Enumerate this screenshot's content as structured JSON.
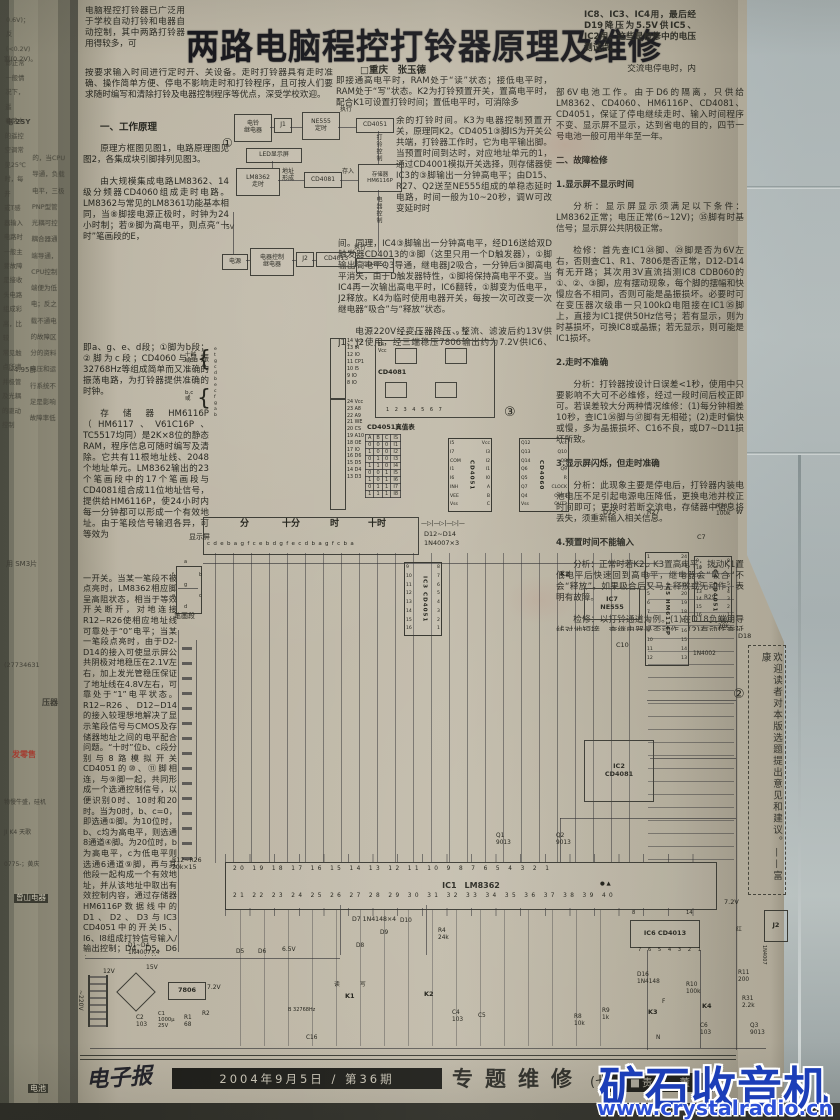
{
  "article": {
    "title": "两路电脑程控打铃器原理及维修",
    "byline": "□重庆　张玉德",
    "pre_title": "电脑程控打铃器已广泛用于学校自动打铃和电器自动控制，其中两路打铃器用得较多，可",
    "intro": "按要求输入时间进行定时开、关设备。走时打铃器具有走时准确、操作简单方便、停电不影响走时和打铃程序，且可按人们要求随时编写和清除打铃及电器控制程序等优点，深受学校欢迎。",
    "sec1_heading": "一、工作原理",
    "left_p1": "原理方框图见图1，电路原理图见图2，各集成块引脚排列见图3。",
    "left_p2": "由大规模集成电路LM8362、14级分频器CD4060组成走时电路。LM8362与常见的LM8361功能基本相同，当⑧脚接电源正极时，时钟为24小时制；若⑨脚为高电平，则点亮“十时”笔画段的E，",
    "left_p3": "即a、g、e、d段；①脚为b段；②脚为c段；CD4060与晶振32768Hz等组成简单而又准确的振荡电路，为打铃器提供准确的时钟。",
    "left_p4": "存储器HM6116P（HM6117、V61C16P、TC5517均同）是2K×8位的静态RAM，程序信息可随时编写及清除。它共有11根地址线、2048个地址单元。LM8362输出的23个笔画段中的17个笔画段与CD4081组合成11位地址信号，提供给HM6116P，使24小时内每一分钟都可以形成一个有效地址。由于笔段信号输迥各异，可等效为",
    "left_p5": "一开关。当某一笔段不被点亮时，LM8362相应脚呈高阻状态，相当于等效开关断开，对地连接R12~R26使相应地址线可靠处于“0”电平；当某一笔段点亮时，由于D2-D14的接入可使显示屏公共阴极对地稳压在2.1V左右，加上发光管稳压保证了地址线在4.8V左右，可靠处于“1”电平状态。R12~R26、D12~D14的接入较理想地解决了显示笔段信号与CMOS及存储器地址之间的电平配合问题。“十时”位b、c段分别与8路模拟开关CD4051的⑩、⑪脚相连，与⑨脚一起，共同形成一个选通控制信号，以便识别0时、10时和20时。当为0时，b、c=0，即选通①脚。为10位时，b、c均为高电平，则选通8通道④脚。为20位时，b为高电平，c为低电平则选通6通道⑨脚，再与其他段一起构成一个有效地址，并从该地址中取出有效控制内容，通过存储器HM6116P数据线中的D1、D2、D3与IC3 CD4051中的开关I5、I6、I8组成打铃信号输入/输出控制；D4、D5、D6与IC4 CD4051中的I5-I8组成电器控制输入/输出信号控制。",
    "left_p6": "K1是选择读/写程序控制键，内接HM6116P的㉑脚WE端，它是编程写入端，",
    "mid_w1": "即接通高电平时，RAM处于“读”状态；接低电平时，RAM处于“写”状态。K2为打铃预置开关，置高电平时，配合K1可设置打铃时间；置低电平时，可消除多",
    "mid_n1": "余的打铃时间。K3为电器控制预置开关，原理同K2。CD4051③脚IS为开关公共端，打铃器工作时，它为电平输出脚。当预置时间到达时，对应地址单元的1，通过CD4001模拟开关选择，则存储器使IC3的③脚输出一分钟高电平；由D15、R27、Q2送至NE555组成的单稳态延时电路，时间一般为10~20秒，调W可改变延时时",
    "mid_w2": "间。同理，IC4③脚输出一分钟高电平，经D16送给双D触发器CD4013的③脚（这里只用一个D触发器），①脚输出高电平Q3导通，继电器J2吸合，一分钟后③脚高电平消失，由于D触发器特性，①脚将保持高电平不变。当IC4再一次输出高电平时，IC6翻转，①脚变为低电平，J2释放。K4为临时使用电器开关，每按一次可改变一次继电器“吸合”与“释放”状态。",
    "mid_w3": "电源220V经变压器降压、整流、滤波后约13V供J1、J2使用，经三端稳压7806输出约为7.2V供IC6、IC7及电器使用；再经D5、D6降压后为6.5V供IC1、",
    "right_top": "IC8、IC3、IC4用，最后经D19降压为5.5V供IC5、IC2用。这些是检修中的电压测试点。",
    "right_top2": "交流电停电时，内",
    "r1": "部6V电池工作。由于D6的隔离，只供给LM8362、CD4060、HM6116P、CD4081、CD4051，保证了停电继续走时、输入时间程序不变、显示屏不显示，达到省电的目的，四节一号电池一般可用半年至一年。",
    "h2": "二、故障检修",
    "h3": "1.显示屏不显示时间",
    "r2": "分析：显示屏显示须满足以下条件：LM8362正常；电压正常(6~12V)；㉟脚有时基信号；显示屏公共阴极正常。",
    "r3": "检修：首先查IC1㉘脚、㉙脚是否为6V左右，否则查C1、R1、7806是否正常，D12-D14有无开路；其次用3V直流挡测IC8 CDB060的①、②、③脚，应有摆动现象，每个脚的摆幅和快慢应各不相同，否则可能是晶振损坏。必要时可在变压器次级串一只100kΩ电阻接在IC1㉟脚上，直接为IC1提供50Hz信号；若有显示，则为时基损坏，可换IC8或晶振；若无显示，则可能是IC1损坏。",
    "h4": "2.走时不准确",
    "r4": "分析：打铃器按设计日误差<1秒，使用中只要影响不大可不必维修，经过一段时间后校正即可。若误差较大分两种情况维修：(1)每分钟相差10秒，查IC1㊱脚与㊲脚有无相碰；(2)走时偏快或慢，多为晶振损坏、C16不良，或D7~D11损坏所致。",
    "h5": "3.显示屏闪烁，但走时准确",
    "r5": "分析：此现象主要是停电后，打铃器内装电池电压不足引起电源电压降低，更换电池并校正时间即可；更换时若断交流电，存储器中信息将丢失，须重新输入相关信息。",
    "h6": "4.预置时间不能输入",
    "r6": "分析：正常时若K2、K3置高电平；拨动K1置低电平后快速回到高电平，继电器会“吸合”不会“释放”。如果吸合后又马上释放或无动作，表明有故障。",
    "r7": "检修：以打铃通道为例。(1)在D18负端用导线对地短接，查继电器是否动作。(2)有动作查延时部分，将D15正极与电源正极短接，看继电器是否动作，否则查NE555及外围元件和Q2是否损坏。(3)查K1是否接触良好，IC5㉑脚电压是否为5.5V左右。(4)查D12-D14是否损坏。(5)若无任何显示可对照真值表试之。(6)以上检查正常仍不能输入，可能是存储器损坏，可直接换IC5或用第4节方法检查。",
    "continue_note": "(下转本期第六版)"
  },
  "figure1": {
    "marker": "①",
    "bell": "电铃\n继电器",
    "j1": "J1",
    "ne555": "NE555\n定时",
    "cd4051a": "CD4051",
    "exec1": "执行",
    "led": "LED显示屏",
    "lm8362": "LM8362\n走时",
    "addr": "地址\n形成",
    "cd4081": "CD4081",
    "store": "存入",
    "mem": "存储器\nHM6116P",
    "bell_ctrl": "打铃控制",
    "dev_ctrl": "电器控制",
    "v5": "5V",
    "power": "电源",
    "ctrl_relay": "电器控制\n继电器",
    "j2": "J2",
    "cd4013": "CD4013",
    "exec2": "执行",
    "cd4051b": "CD4051"
  },
  "figure3": {
    "truth": {
      "title": "CD4051真值表",
      "head": [
        "A",
        "B",
        "C",
        "IS"
      ],
      "rows": [
        [
          "0",
          "0",
          "0",
          "I1"
        ],
        [
          "1",
          "0",
          "0",
          "I2"
        ],
        [
          "0",
          "1",
          "0",
          "I3"
        ],
        [
          "1",
          "1",
          "0",
          "I4"
        ],
        [
          "0",
          "0",
          "1",
          "I5"
        ],
        [
          "1",
          "0",
          "1",
          "I6"
        ],
        [
          "0",
          "1",
          "1",
          "I7"
        ],
        [
          "1",
          "1",
          "1",
          "I8"
        ]
      ]
    },
    "dips": [
      {
        "name": "CD4051",
        "left": [
          "I5",
          "I7",
          "COM",
          "I1",
          "I6",
          "INH",
          "VEE",
          "Vss"
        ],
        "right": [
          "Vcc",
          "I3",
          "I2",
          "I1",
          "I0",
          "A",
          "B",
          "C"
        ],
        "x": 448,
        "y": 438,
        "w": 42,
        "h": 72
      },
      {
        "name": "CD4060",
        "left": [
          "Q12",
          "Q13",
          "Q14",
          "Q6",
          "Q5",
          "Q7",
          "Q4",
          "Vss"
        ],
        "right": [
          "Vcc",
          "Q10",
          "Q8",
          "Q9",
          "R",
          "CLOCK",
          "OUT1",
          "OUT2"
        ],
        "x": 519,
        "y": 438,
        "w": 48,
        "h": 72
      },
      {
        "name": "IC3 CD4051",
        "left": [
          "9",
          "10",
          "11",
          "12",
          "13",
          "14",
          "15",
          "16"
        ],
        "right": [
          "8",
          "7",
          "6",
          "5",
          "4",
          "3",
          "2",
          "1"
        ],
        "x": 404,
        "y": 562,
        "w": 36,
        "h": 72
      },
      {
        "name": "IC4 CD4051",
        "left": [
          "9",
          "10",
          "11",
          "12",
          "13",
          "14",
          "15",
          "16"
        ],
        "right": [
          "8",
          "7",
          "6",
          "5",
          "4",
          "3",
          "2",
          "1"
        ],
        "x": 694,
        "y": 556,
        "w": 36,
        "h": 64
      },
      {
        "name": "IC5 HM6116P",
        "left": [
          "1",
          "2",
          "3",
          "4",
          "5",
          "6",
          "7",
          "8",
          "9",
          "10",
          "11",
          "12"
        ],
        "right": [
          "24",
          "23",
          "22",
          "21",
          "20",
          "19",
          "18",
          "17",
          "16",
          "15",
          "14",
          "13"
        ],
        "x": 645,
        "y": 552,
        "w": 42,
        "h": 112
      }
    ]
  },
  "schematic": {
    "ic7_label": "IC7\nNE555",
    "ic2_label": "IC2\nCD4081",
    "ic6_label": "IC6  CD4013",
    "ic1_label": "IC1　LM8362",
    "j2_label": "J2",
    "reg_label": "7806",
    "labels": [
      {
        "t": "显示屏",
        "x": 189,
        "y": 533,
        "s": 7
      },
      {
        "t": "分",
        "x": 240,
        "y": 519,
        "s": 9,
        "b": 1
      },
      {
        "t": "十分",
        "x": 282,
        "y": 519,
        "s": 9,
        "b": 1
      },
      {
        "t": "时",
        "x": 330,
        "y": 519,
        "s": 9,
        "b": 1
      },
      {
        "t": "十时",
        "x": 368,
        "y": 519,
        "s": 9,
        "b": 1
      },
      {
        "t": "c d e b a g f c e b d g f e c d b a g f c b a",
        "x": 207,
        "y": 541,
        "s": 5.5,
        "ls": 0.8
      },
      {
        "t": "—▷|—▷|—▷|—",
        "x": 421,
        "y": 521,
        "s": 6
      },
      {
        "t": "D12~D14",
        "x": 424,
        "y": 531,
        "s": 6.5
      },
      {
        "t": "1N4007×3",
        "x": 424,
        "y": 540,
        "s": 6.5
      },
      {
        "t": "笔画段",
        "x": 174,
        "y": 612,
        "s": 7
      },
      {
        "t": "a",
        "x": 184,
        "y": 560,
        "s": 5
      },
      {
        "t": "f",
        "x": 172,
        "y": 573,
        "s": 5
      },
      {
        "t": "b",
        "x": 199,
        "y": 573,
        "s": 5
      },
      {
        "t": "g",
        "x": 184,
        "y": 583,
        "s": 5
      },
      {
        "t": "e",
        "x": 172,
        "y": 594,
        "s": 5
      },
      {
        "t": "c",
        "x": 199,
        "y": 594,
        "s": 5
      },
      {
        "t": "d",
        "x": 184,
        "y": 605,
        "s": 5
      },
      {
        "t": "十时\n或",
        "x": 185,
        "y": 352,
        "s": 5.5
      },
      {
        "t": "b,c\n或",
        "x": 185,
        "y": 390,
        "s": 5.5
      },
      {
        "t": "{",
        "x": 197,
        "y": 347,
        "s": 22
      },
      {
        "t": "{",
        "x": 197,
        "y": 386,
        "s": 22
      },
      {
        "t": "e\nt\ng\nc\nd\nb\ne\nc\nf\ng\na\nb",
        "x": 214,
        "y": 347,
        "s": 4.6,
        "lh": 1.3
      },
      {
        "t": "14 Vcc\n13 IR\n12 IO\n11 CP1\n10 I5\n 9 IO\n 8 IO",
        "x": 347,
        "y": 339,
        "s": 4.8,
        "lh": 1.45
      },
      {
        "t": "24 Vcc\n23 A8\n22 A9\n21 WE\n20 CS\n19 A10\n18 OE\n17 IO\n16 D6\n15 D5\n14 D4\n13 D3",
        "x": 347,
        "y": 400,
        "s": 4.8,
        "lh": 1.42
      },
      {
        "t": "CD4081",
        "x": 378,
        "y": 369,
        "s": 6.5,
        "b": 1
      },
      {
        "t": "14\nVcc",
        "x": 378,
        "y": 343,
        "s": 4.8
      },
      {
        "t": "13    12    11    10     9     8",
        "x": 400,
        "y": 332,
        "s": 5,
        "ls": 2
      },
      {
        "t": "1     2     3     4     5     6     7",
        "x": 386,
        "y": 408,
        "s": 5,
        "ls": 2
      },
      {
        "t": "CD4051真值表",
        "x": 367,
        "y": 424,
        "s": 6.5,
        "b": 1
      },
      {
        "t": "③",
        "x": 504,
        "y": 406,
        "s": 13
      },
      {
        "t": "②",
        "x": 733,
        "y": 688,
        "s": 13
      },
      {
        "t": "D15",
        "x": 603,
        "y": 509,
        "s": 6.5
      },
      {
        "t": "R27",
        "x": 647,
        "y": 509,
        "s": 6.5
      },
      {
        "t": "R28\n100k",
        "x": 716,
        "y": 504,
        "s": 5.8
      },
      {
        "t": "W",
        "x": 736,
        "y": 509,
        "s": 6.5
      },
      {
        "t": "C7",
        "x": 697,
        "y": 534,
        "s": 6.5
      },
      {
        "t": "K2",
        "x": 560,
        "y": 571,
        "s": 6.5,
        "b": 1
      },
      {
        "t": "C10",
        "x": 616,
        "y": 642,
        "s": 6.5
      },
      {
        "t": "R29",
        "x": 704,
        "y": 595,
        "s": 5.8
      },
      {
        "t": "R20\n20k",
        "x": 718,
        "y": 617,
        "s": 5.8
      },
      {
        "t": "D18",
        "x": 738,
        "y": 633,
        "s": 6.5
      },
      {
        "t": "1N4002",
        "x": 693,
        "y": 651,
        "s": 5.8
      },
      {
        "t": "Q1\n9013",
        "x": 496,
        "y": 833,
        "s": 5.8
      },
      {
        "t": "Q2\n9013",
        "x": 556,
        "y": 833,
        "s": 5.8
      },
      {
        "t": "R12~R26\n20k×15",
        "x": 172,
        "y": 857,
        "s": 6.2
      },
      {
        "t": "20 19 18 17 16 15 14 13 12 11 10  9  8  7  6  5  4  3  2  1",
        "x": 233,
        "y": 866,
        "s": 5.8,
        "ls": 3.4
      },
      {
        "t": "21 22 23 24 25 26 27 28 29 30 31 32 33 34 35 36 37 38 39 40",
        "x": 233,
        "y": 893,
        "s": 5.8,
        "ls": 3.4
      },
      {
        "t": "● ▲",
        "x": 600,
        "y": 881,
        "s": 5.5
      },
      {
        "t": "D7  1N4148×4",
        "x": 352,
        "y": 916,
        "s": 6.2
      },
      {
        "t": "D8",
        "x": 356,
        "y": 943,
        "s": 5.8
      },
      {
        "t": "D9",
        "x": 380,
        "y": 930,
        "s": 5.8
      },
      {
        "t": "D10",
        "x": 400,
        "y": 918,
        "s": 5.8
      },
      {
        "t": "R4\n24k",
        "x": 438,
        "y": 928,
        "s": 5.8
      },
      {
        "t": "8",
        "x": 632,
        "y": 911,
        "s": 5.2
      },
      {
        "t": "14",
        "x": 686,
        "y": 911,
        "s": 5.2
      },
      {
        "t": "7 6 5 4 3 2 1",
        "x": 638,
        "y": 948,
        "s": 5.2,
        "ls": 2.5
      },
      {
        "t": "D16\n1N4148",
        "x": 637,
        "y": 972,
        "s": 5.8
      },
      {
        "t": "R10\n100k",
        "x": 686,
        "y": 982,
        "s": 5.8
      },
      {
        "t": "K4",
        "x": 702,
        "y": 1003,
        "s": 6.5,
        "b": 1
      },
      {
        "t": "C6\n103",
        "x": 700,
        "y": 1023,
        "s": 5.8
      },
      {
        "t": "K3",
        "x": 648,
        "y": 1009,
        "s": 6.5,
        "b": 1
      },
      {
        "t": "F",
        "x": 662,
        "y": 999,
        "s": 5.8
      },
      {
        "t": "N",
        "x": 656,
        "y": 1035,
        "s": 5.8
      },
      {
        "t": "R9\n1k",
        "x": 602,
        "y": 1008,
        "s": 5.8
      },
      {
        "t": "R8\n10k",
        "x": 574,
        "y": 1014,
        "s": 5.8
      },
      {
        "t": "R11\n200",
        "x": 738,
        "y": 970,
        "s": 5.8
      },
      {
        "t": "R31\n2.2k",
        "x": 742,
        "y": 996,
        "s": 5.8
      },
      {
        "t": "Q3\n9013",
        "x": 750,
        "y": 1023,
        "s": 5.8
      },
      {
        "t": "1N4007",
        "x": 760,
        "y": 945,
        "s": 5,
        "v": 1
      },
      {
        "t": "红",
        "x": 736,
        "y": 927,
        "s": 5.8
      },
      {
        "t": "7.2V",
        "x": 724,
        "y": 899,
        "s": 6.5
      },
      {
        "t": "~220V",
        "x": 76,
        "y": 990,
        "s": 6,
        "v": 1
      },
      {
        "t": "12V",
        "x": 103,
        "y": 969,
        "s": 6
      },
      {
        "t": "D1~D4\n1N4007×4",
        "x": 128,
        "y": 943,
        "s": 5.8
      },
      {
        "t": "15V",
        "x": 146,
        "y": 965,
        "s": 6
      },
      {
        "t": "7.2V",
        "x": 207,
        "y": 985,
        "s": 6
      },
      {
        "t": "C2\n103",
        "x": 136,
        "y": 1015,
        "s": 5.8
      },
      {
        "t": "C1\n1000µ\n25V",
        "x": 158,
        "y": 1012,
        "s": 5.2
      },
      {
        "t": "R1\n68",
        "x": 184,
        "y": 1015,
        "s": 5.8
      },
      {
        "t": "R2",
        "x": 202,
        "y": 1011,
        "s": 5.8
      },
      {
        "t": "D5",
        "x": 236,
        "y": 949,
        "s": 5.8
      },
      {
        "t": "D6",
        "x": 258,
        "y": 949,
        "s": 5.8
      },
      {
        "t": "6.5V",
        "x": 282,
        "y": 947,
        "s": 6
      },
      {
        "t": "读",
        "x": 334,
        "y": 982,
        "s": 5.8
      },
      {
        "t": "K1",
        "x": 345,
        "y": 993,
        "s": 6.5,
        "b": 1
      },
      {
        "t": "写",
        "x": 360,
        "y": 982,
        "s": 5.8
      },
      {
        "t": "B 32768Hz",
        "x": 288,
        "y": 1008,
        "s": 5
      },
      {
        "t": "C16",
        "x": 306,
        "y": 1035,
        "s": 5.8
      },
      {
        "t": "K2",
        "x": 424,
        "y": 991,
        "s": 6.5,
        "b": 1
      },
      {
        "t": "C4\n103",
        "x": 452,
        "y": 1010,
        "s": 5.8
      },
      {
        "t": "C5",
        "x": 478,
        "y": 1013,
        "s": 5.8
      }
    ]
  },
  "notice": {
    "text": "欢迎读者对本版选题提出意见和建议。——富康"
  },
  "footer": {
    "logo": "电子报",
    "date_issue": "2004年9月5日 / 第36期",
    "section": "专题维修",
    "edition": "(七版)",
    "editor": "■责编　董"
  },
  "watermark": {
    "title": "矿石收音机",
    "url": "www.crystalradio.cn"
  },
  "spine": {
    "colA": "0.6V)；反\n(<0.2V)\n即正常\n一般情\n况下，遥\n电路中\n的遥控\n空调常\n见25℃\n时，每开\n或T感\n器输入\n电路时\n一般主\n要故障\n是接收\n头电路\n组成彩\n高，比较\n常见触\n点所噶\n并极管\n及光耦\n的驱动\n控制",
    "colB": "的，当CPU\n导通，负载\n电平，三极\nPNP型管\n光耦可控\n耦合器通\n端导通，\nCPU控制\n端便为低\n电；反之\n载不通电\n的故障区\n分的资料\n电压和运\n行系统不\n足是影响\n故障率低",
    "ads": [
      {
        "t": "割(0.2V)。",
        "x": 4,
        "y": 56,
        "s": 6.5,
        "cls": "sp"
      },
      {
        "t": "电 2SY",
        "x": 6,
        "y": 118,
        "s": 7,
        "cls": "sp",
        "b": 1
      },
      {
        "t": "≈4.95卧",
        "x": 8,
        "y": 366,
        "s": 7,
        "cls": "sp"
      },
      {
        "t": "用 SM3片",
        "x": 6,
        "y": 560,
        "s": 7,
        "cls": "sp"
      },
      {
        "t": "(27734631",
        "x": 4,
        "y": 662,
        "s": 6.5,
        "cls": "sp"
      },
      {
        "t": "压器",
        "x": 42,
        "y": 698,
        "s": 8,
        "cls": "sp",
        "b": 1
      },
      {
        "t": "发零售",
        "x": 12,
        "y": 750,
        "s": 8,
        "cls": "red"
      },
      {
        "t": "物慢牛盛，硅机",
        "x": 4,
        "y": 800,
        "s": 6,
        "cls": "sp"
      },
      {
        "t": "JI K4 天歌",
        "x": 4,
        "y": 830,
        "s": 6,
        "cls": "sp"
      },
      {
        "t": "0775-；黄庆",
        "x": 4,
        "y": 862,
        "s": 6,
        "cls": "sp"
      },
      {
        "t": "曾山电器",
        "x": 14,
        "y": 894,
        "s": 7.5,
        "cls": "inv"
      },
      {
        "t": "电池",
        "x": 28,
        "y": 1084,
        "s": 8,
        "cls": "inv"
      }
    ]
  }
}
